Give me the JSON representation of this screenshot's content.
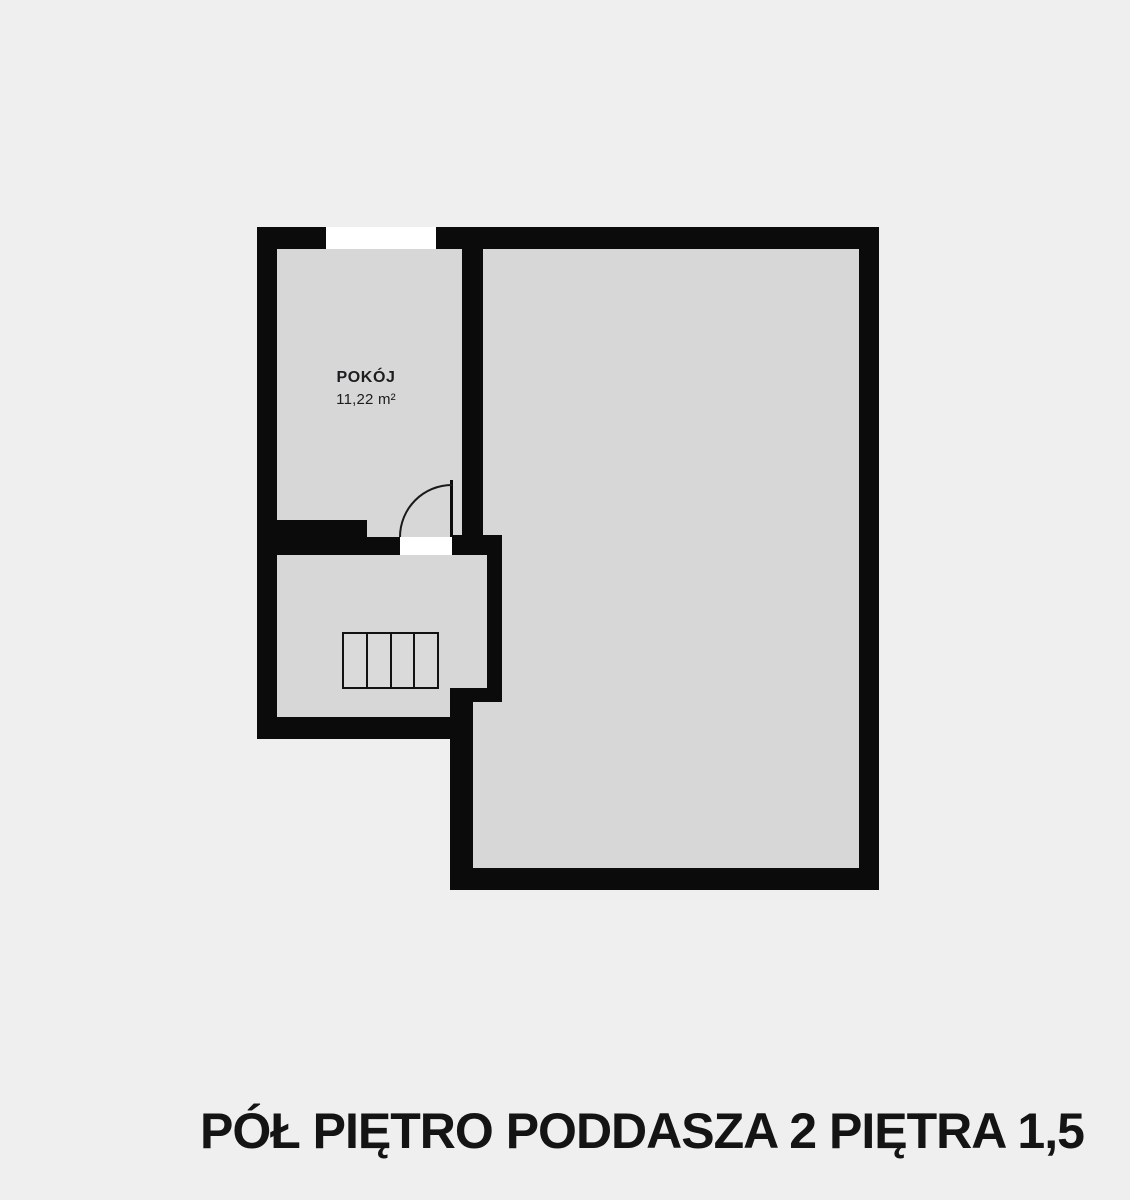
{
  "caption": {
    "text": "PÓŁ PIĘTRO PODDASZA 2 PIĘTRA 1,5"
  },
  "room": {
    "name": "POKÓJ",
    "area": "11,22 m²"
  },
  "colors": {
    "background": "#efefef",
    "floor": "#d7d7d7",
    "wall": "#0b0b0b",
    "opening": "#ffffff",
    "stairs_fill": "#dadada",
    "label_text": "#1d1d1f",
    "caption_text": "#141414"
  },
  "plan": {
    "floors": [
      {
        "id": "floor-small-rooms",
        "x": 257,
        "y": 227,
        "w": 245,
        "h": 512
      },
      {
        "id": "floor-large-room",
        "x": 450,
        "y": 227,
        "w": 429,
        "h": 663
      }
    ],
    "walls": [
      {
        "id": "top-wall",
        "x": 257,
        "y": 227,
        "w": 622,
        "h": 22
      },
      {
        "id": "left-wall",
        "x": 257,
        "y": 227,
        "w": 20,
        "h": 512
      },
      {
        "id": "right-wall",
        "x": 859,
        "y": 227,
        "w": 20,
        "h": 663
      },
      {
        "id": "bottom-wall",
        "x": 450,
        "y": 868,
        "w": 429,
        "h": 22
      },
      {
        "id": "stair-bottom-wall",
        "x": 257,
        "y": 717,
        "w": 216,
        "h": 22
      },
      {
        "id": "pokoj-divider-wall",
        "x": 462,
        "y": 249,
        "w": 21,
        "h": 288
      },
      {
        "id": "pokoj-step-wall",
        "x": 277,
        "y": 520,
        "w": 90,
        "h": 17
      },
      {
        "id": "stair-top-wall",
        "x": 277,
        "y": 537,
        "w": 123,
        "h": 18
      },
      {
        "id": "door-jamb-wall",
        "x": 452,
        "y": 535,
        "w": 50,
        "h": 20
      },
      {
        "id": "stair-divider-wall",
        "x": 487,
        "y": 555,
        "w": 15,
        "h": 147
      },
      {
        "id": "jog-wall",
        "x": 450,
        "y": 688,
        "w": 52,
        "h": 14
      },
      {
        "id": "lower-left-wall",
        "x": 450,
        "y": 688,
        "w": 23,
        "h": 202
      }
    ],
    "openings": [
      {
        "id": "window-opening",
        "x": 326,
        "y": 227,
        "w": 110,
        "h": 22
      },
      {
        "id": "door-opening",
        "x": 400,
        "y": 537,
        "w": 52,
        "h": 18
      }
    ],
    "door": {
      "leaf": {
        "x": 450,
        "y": 480,
        "w": 3,
        "h": 57
      },
      "swing_arc": {
        "x": 399,
        "y": 484,
        "w": 53,
        "h": 53
      }
    },
    "stairs": {
      "x": 342,
      "y": 632,
      "w": 97,
      "h": 57,
      "steps": 4
    }
  }
}
